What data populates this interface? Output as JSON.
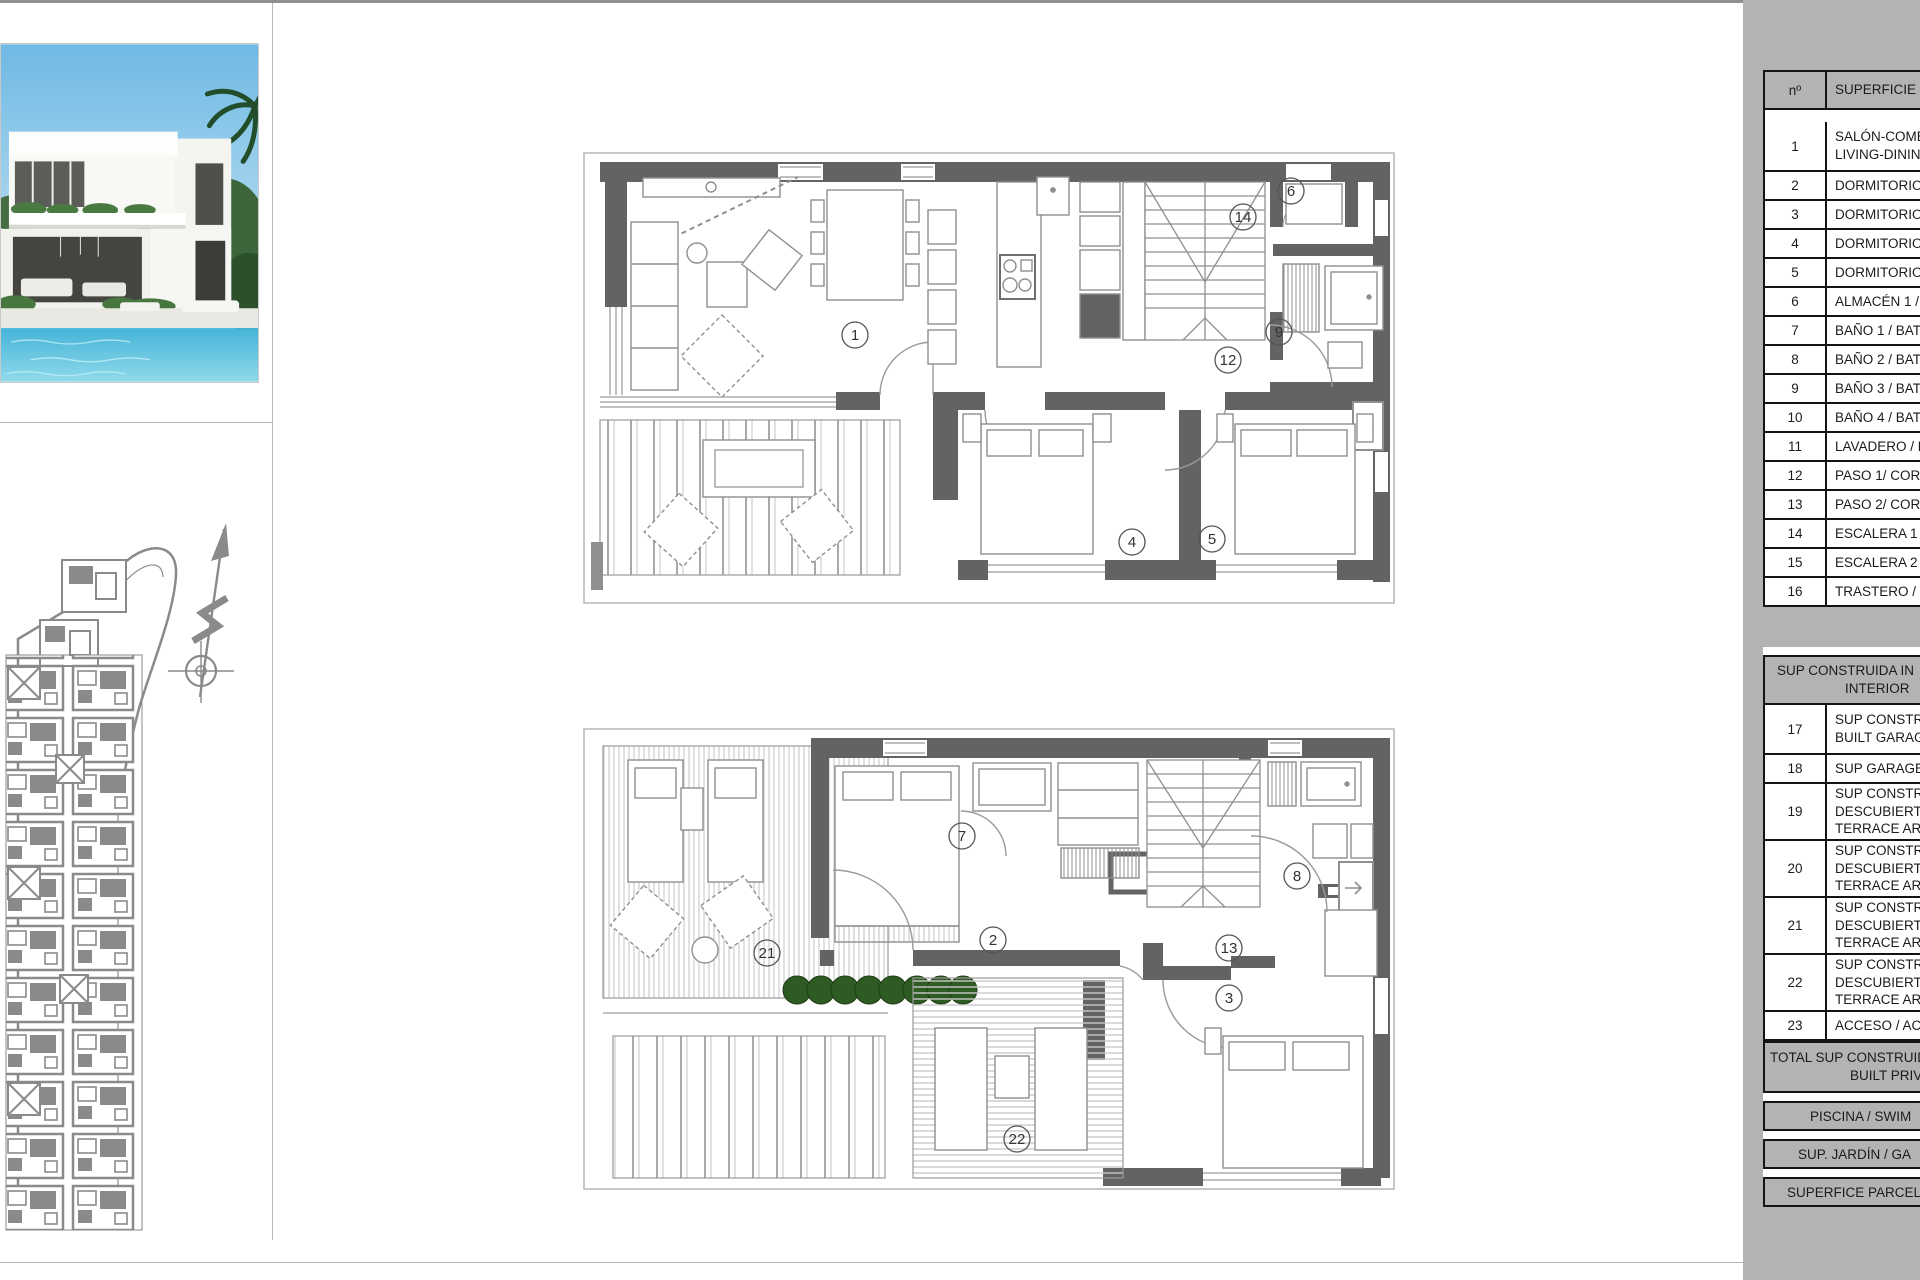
{
  "area_table": {
    "header": {
      "num": "nº",
      "label": "SUPERFICIE Ú"
    },
    "rows": [
      {
        "num": "1",
        "lines": [
          "SALÓN-COME",
          "LIVING-DININ"
        ]
      },
      {
        "num": "2",
        "lines": [
          "DORMITORIO"
        ]
      },
      {
        "num": "3",
        "lines": [
          "DORMITORIO"
        ]
      },
      {
        "num": "4",
        "lines": [
          "DORMITORIO"
        ]
      },
      {
        "num": "5",
        "lines": [
          "DORMITORIO"
        ]
      },
      {
        "num": "6",
        "lines": [
          "ALMACÉN 1 /"
        ]
      },
      {
        "num": "7",
        "lines": [
          "BAÑO 1 / BATH"
        ]
      },
      {
        "num": "8",
        "lines": [
          "BAÑO 2 / BATH"
        ]
      },
      {
        "num": "9",
        "lines": [
          "BAÑO 3 / BATH"
        ]
      },
      {
        "num": "10",
        "lines": [
          "BAÑO 4 / BATH"
        ]
      },
      {
        "num": "11",
        "lines": [
          "LAVADERO / L"
        ]
      },
      {
        "num": "12",
        "lines": [
          "PASO 1/ CORR"
        ]
      },
      {
        "num": "13",
        "lines": [
          "PASO 2/ CORR"
        ]
      },
      {
        "num": "14",
        "lines": [
          "ESCALERA 1 /"
        ]
      },
      {
        "num": "15",
        "lines": [
          "ESCALERA 2 /"
        ]
      },
      {
        "num": "16",
        "lines": [
          "TRASTERO / S"
        ]
      }
    ],
    "mid_header_lines": [
      "SUP CONSTRUIDA IN",
      "INTERIOR"
    ],
    "rows2": [
      {
        "num": "17",
        "lines": [
          "SUP CONSTRU",
          "BUILT GARAG"
        ]
      },
      {
        "num": "18",
        "lines": [
          "SUP GARAGE/"
        ]
      },
      {
        "num": "19",
        "lines": [
          "SUP CONSTRU",
          "DESCUBIERTA",
          "TERRACE ARE"
        ]
      },
      {
        "num": "20",
        "lines": [
          "SUP CONSTRU",
          "DESCUBIERTA",
          "TERRACE ARE"
        ]
      },
      {
        "num": "21",
        "lines": [
          "SUP CONSTRU",
          "DESCUBIERTA",
          "TERRACE ARE"
        ]
      },
      {
        "num": "22",
        "lines": [
          "SUP CONSTRU",
          "DESCUBIERTA",
          "TERRACE ARE"
        ]
      },
      {
        "num": "23",
        "lines": [
          "ACCESO / ACC"
        ]
      }
    ],
    "total_lines": [
      "TOTAL SUP CONSTRUIDA",
      "BUILT PRIVA"
    ],
    "bands": [
      "PISCINA / SWIM",
      "SUP. JARDÍN / GA",
      "SUPERFICE PARCEL"
    ]
  },
  "plans": {
    "upper": {
      "circles": [
        {
          "n": "1",
          "x": 272,
          "y": 183
        },
        {
          "n": "14",
          "x": 660,
          "y": 65
        },
        {
          "n": "6",
          "x": 708,
          "y": 39
        },
        {
          "n": "9",
          "x": 696,
          "y": 180
        },
        {
          "n": "12",
          "x": 645,
          "y": 208
        },
        {
          "n": "4",
          "x": 549,
          "y": 390
        },
        {
          "n": "5",
          "x": 629,
          "y": 387
        }
      ]
    },
    "lower": {
      "circles": [
        {
          "n": "7",
          "x": 379,
          "y": 108
        },
        {
          "n": "2",
          "x": 410,
          "y": 212
        },
        {
          "n": "21",
          "x": 184,
          "y": 225
        },
        {
          "n": "8",
          "x": 714,
          "y": 148
        },
        {
          "n": "13",
          "x": 646,
          "y": 220
        },
        {
          "n": "3",
          "x": 646,
          "y": 270
        },
        {
          "n": "22",
          "x": 434,
          "y": 411
        }
      ]
    }
  },
  "colors": {
    "panel_bg": "#b3b3b3",
    "wall": "#636363",
    "thin_line": "#9a9a9a",
    "furniture": "#8f8f8f",
    "bush_green": "#2e5a23",
    "site_gray": "#8a8a8a",
    "pool": "#58c0dd",
    "sky": "#8ec9ea"
  }
}
